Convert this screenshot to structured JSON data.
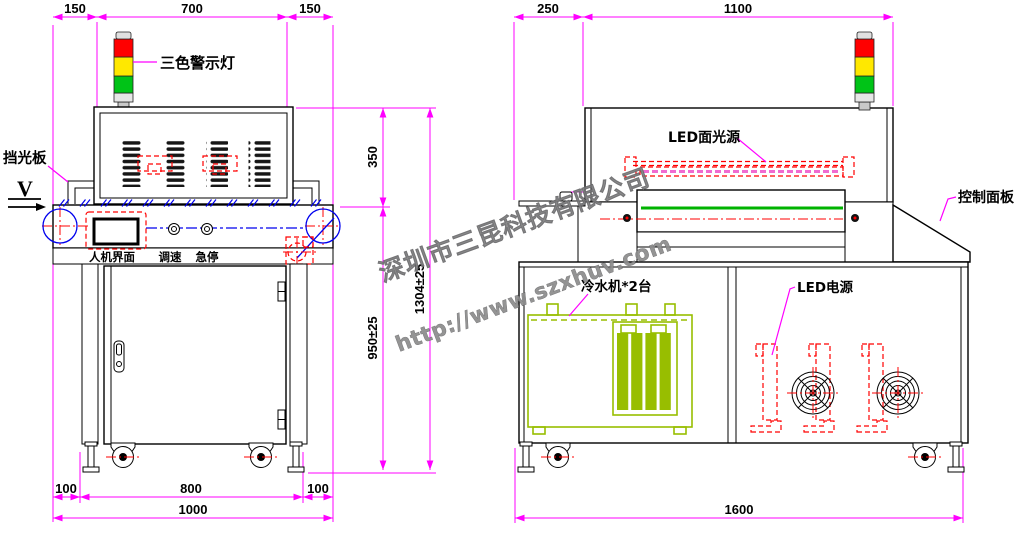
{
  "drawing": {
    "watermark": {
      "company": "深圳市三昆科技有限公司",
      "website": "http://www.szxhuv.com"
    },
    "front_view": {
      "callouts": {
        "warning_light": "三色警示灯",
        "light_shield": "挡光板",
        "view_marker": "V"
      },
      "panel_labels": {
        "hmi": "人机界面",
        "speed": "调速",
        "estop": "急停"
      },
      "dimensions": {
        "top_left": "150",
        "top_width": "700",
        "top_right": "150",
        "hood_height": "350",
        "total_height": "1304±25",
        "table_height": "950±25",
        "bottom_left": "100",
        "bottom_width": "800",
        "bottom_right": "100",
        "total_width": "1000"
      }
    },
    "side_view": {
      "callouts": {
        "led_source": "LED面光源",
        "control_panel": "控制面板",
        "led_power": "LED电源",
        "chiller": "冷水机*2台"
      },
      "dimensions": {
        "inlet": "250",
        "body_width": "1100",
        "belt_width": "700",
        "total_length": "1600"
      }
    },
    "colors": {
      "dim": "#ff00ff",
      "red": "#ff0000",
      "blue": "#0000ee",
      "belt": "#00b300",
      "chiller": "#98be00",
      "led_pink": "#f06ad0",
      "wm": "#8c8c8c",
      "lamp_red": "#ff0000",
      "lamp_yellow": "#ffe800",
      "lamp_green": "#00c317"
    }
  }
}
